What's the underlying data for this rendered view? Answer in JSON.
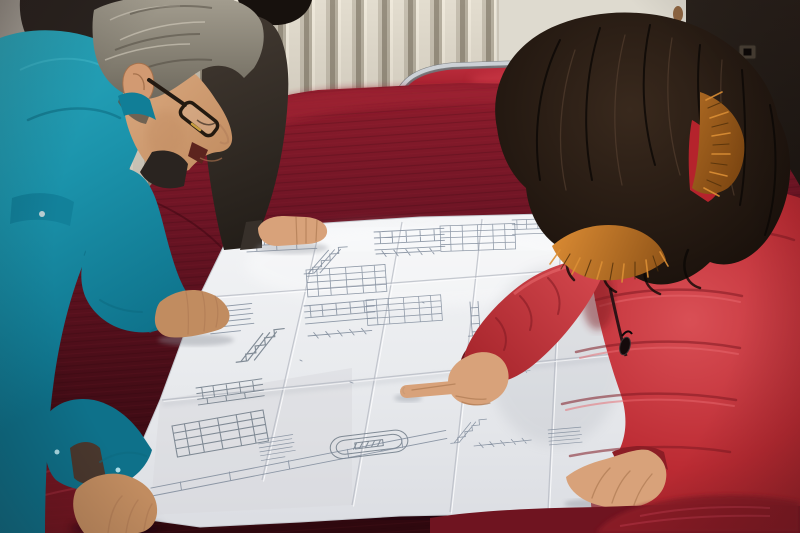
{
  "scene": {
    "setting": "indoor room with a cream ribbed radiator wall, a dark brown door on the right, and a table draped in dark red velvet",
    "action": "Three people lean over a large folded engineering blueprint spread on a red velvet table; the woman in red points at a detail",
    "people": [
      {
        "id": "man-left",
        "description": "middle-aged man with gray hair and dark glasses wearing a teal work jacket, both hands resting on the drawing"
      },
      {
        "id": "person-behind",
        "description": "partially hidden person in a dark jacket standing behind the man, one hand resting on the far edge of the drawing"
      },
      {
        "id": "woman-right",
        "description": "woman with long dark wavy hair in a red padded coat with an orange fur-trimmed hood, pointing with her right index finger, left hand resting on the drawing"
      }
    ],
    "objects": [
      {
        "id": "blueprint",
        "description": "large white multi-fold technical drawing sheet with stair sections, elevation details, dimension lines, small data tables and a stadium-shaped detail"
      },
      {
        "id": "velvet-table",
        "description": "table covered in dark maroon velvet, brighter crimson where the light hits"
      },
      {
        "id": "chair",
        "description": "chrome framed chair with bright red upholstered back behind the table"
      },
      {
        "id": "door",
        "description": "very dark brown door with a small latch plate"
      },
      {
        "id": "radiator-wall",
        "description": "cream vertically ribbed radiator panel along the back wall"
      },
      {
        "id": "wall-stain",
        "description": "small rust stain on the wall beside the door"
      }
    ]
  },
  "colors": {
    "wall": "#d6d1c7",
    "wallRight": "#dedacf",
    "wallShade": "#9a958c",
    "radiatorFace": "#e3ddcf",
    "door": "#1a1410",
    "doorEdge": "#57503f",
    "chrome": "#cdd1d6",
    "chairRed": "#b01f30",
    "velvetTop": "#8e1c2c",
    "velvetMid": "#5c1220",
    "velvetDark": "#2e080e",
    "velvetBright": "#a12737",
    "paper": "#eceef1",
    "paperDim": "#d9dbe0",
    "ink": "#7e8a9a",
    "teal": "#1b98b0",
    "tealLight": "#3ab6c8",
    "tealDark": "#0c6a80",
    "skin": "#d8a27a",
    "skinShadow": "#b07c55",
    "hairGray": "#8f897c",
    "hairGrayDark": "#4e483e",
    "hairGrayLight": "#d5cfc0",
    "darkJacket": "#37302a",
    "darkHair": "#17110d",
    "coat": "#c13038",
    "coatLight": "#e8686d",
    "coatDark": "#801a22",
    "womanHair": "#241a14",
    "womanHairLight": "#5c4635",
    "fur": "#c47527",
    "furDark": "#6e3c0e"
  }
}
